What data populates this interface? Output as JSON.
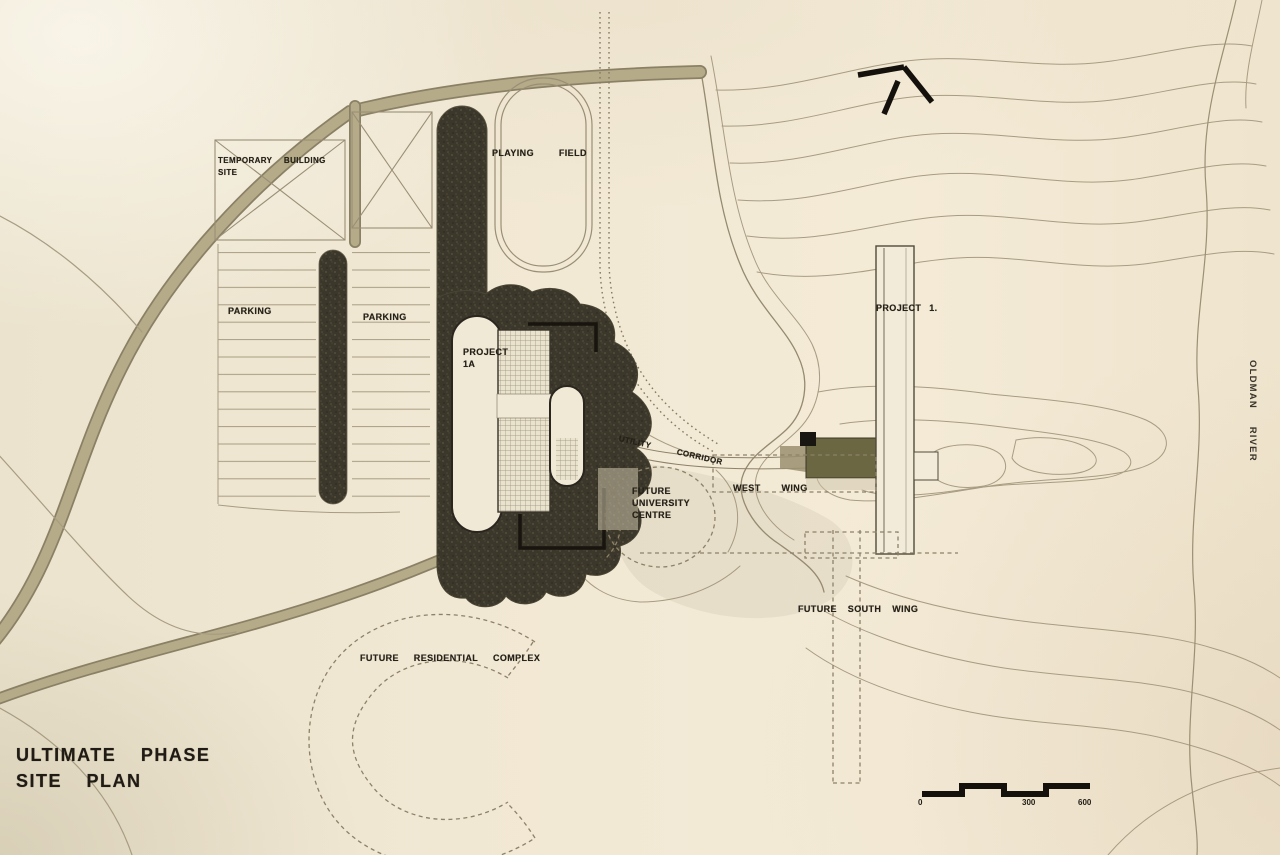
{
  "plan": {
    "title": {
      "line1": "ULTIMATE PHASE",
      "line2": "SITE PLAN"
    },
    "labels": {
      "temporary_building_site": {
        "line1": "TEMPORARY BUILDING",
        "line2": "SITE"
      },
      "playing_field": "PLAYING FIELD",
      "parking_west": "PARKING",
      "parking_east": "PARKING",
      "project_1a": {
        "line1": "PROJECT",
        "line2": "1A"
      },
      "utility_corridor": "UTILITY CORRIDOR",
      "future_university_centre": {
        "line1": "FUTURE",
        "line2": "UNIVERSITY",
        "line3": "CENTRE"
      },
      "west_wing": "WEST WING",
      "project_1": "PROJECT 1.",
      "future_south_wing": "FUTURE SOUTH WING",
      "future_residential_complex": "FUTURE RESIDENTIAL COMPLEX",
      "oldman_river": "OLDMAN RIVER"
    },
    "scale_bar": {
      "start": "0",
      "mid": "300",
      "end": "600"
    },
    "icons": {
      "north_arrow": "north-arrow"
    },
    "colors": {
      "paper": "#f1e8d4",
      "ink": "#262219",
      "contour": "#a89c82",
      "dark_mass": "#3b372b",
      "road": "#b5ab88",
      "olive_band": "#6b6743"
    }
  }
}
